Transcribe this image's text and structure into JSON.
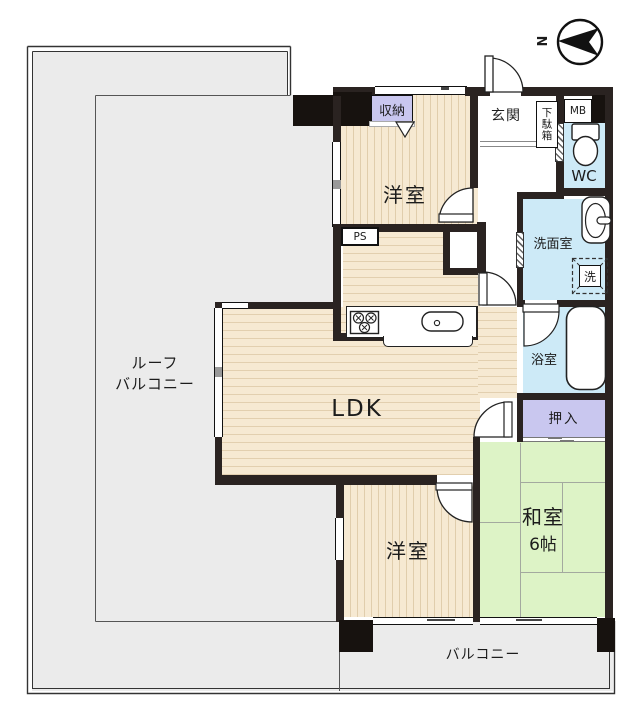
{
  "title": "apartment-floor-plan",
  "compass": {
    "north_label": "N"
  },
  "outdoor": {
    "roof_balcony_line1": "ルーフ",
    "roof_balcony_line2": "バルコニー",
    "balcony": "バルコニー"
  },
  "rooms": {
    "bedroom_top": "洋室",
    "bedroom_bottom": "洋室",
    "ldk": "LDK",
    "japanese_room": "和室",
    "japanese_room_size": "6帖",
    "entrance": "玄関",
    "toilet": "WC",
    "washroom": "洗面室",
    "bathroom": "浴室",
    "closet_top": "収納",
    "oshiire": "押入"
  },
  "fixtures": {
    "shoe_cabinet": "下駄箱",
    "meter_box": "MB",
    "pipe_space": "PS",
    "washer": "洗"
  },
  "colors": {
    "wall": "#2a2321",
    "wood_floor": "#f6e9d2",
    "tatami": "#ddf3c6",
    "wet_area": "#cdeaf7",
    "closet_fill": "#c9c7ef",
    "outdoor_gray": "#ebebeb"
  }
}
